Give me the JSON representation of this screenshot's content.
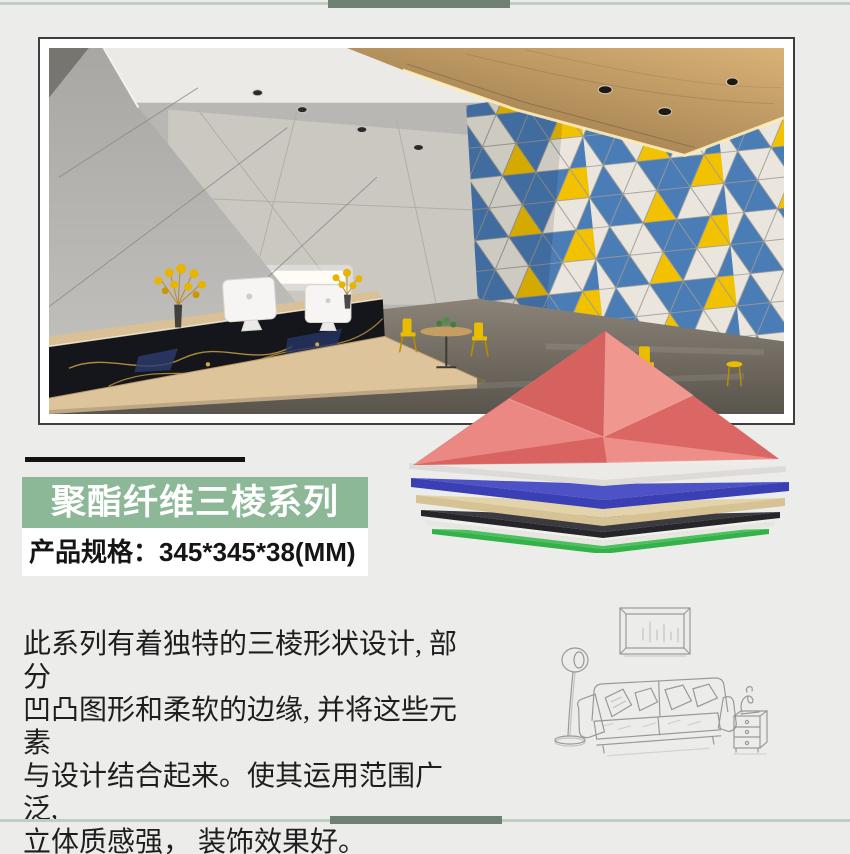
{
  "banner": {
    "label": "聚酯纤维三棱系列"
  },
  "spec": {
    "label": "产品规格：345*345*38(MM)"
  },
  "description": {
    "lines": [
      "此系列有着独特的三棱形状设计, 部分",
      "凹凸图形和柔软的边缘, 并将这些元素",
      "与设计结合起来。使其运用范围广泛,",
      "立体质感强， 装饰效果好。"
    ]
  },
  "images": {
    "hero": "office-lobby-with-triangle-acoustic-feature-wall",
    "product": "stacked-triangle-acoustic-felt-panels",
    "sketch": "hand-drawn-sofa-lamp-and-side-table"
  },
  "colors": {
    "page_bg": "#ecedeb",
    "decor_line": "#bdcfc2",
    "decor_bar": "#6f8172",
    "title_rule": "#121212",
    "banner_bg": "#8cb897",
    "banner_text": "#ffffff",
    "spec_bg": "#ffffff",
    "spec_text": "#151515",
    "desc_text": "#1e1e1e",
    "frame_border": "#3e3e3c",
    "frame_matte": "#ffffff",
    "sketch_stroke": "#909090",
    "panel_pink": "#e26e6a",
    "panel_pink_light": "#f09790",
    "panel_pink_dark": "#d4605d",
    "panel_white": "#dcdbd7",
    "panel_white_top": "#ebeae6",
    "panel_blue": "#3b3fb4",
    "panel_blue_top": "#4d52c6",
    "panel_tan": "#d6c294",
    "panel_tan_top": "#e3d3ab",
    "panel_black": "#26262a",
    "panel_black_top": "#3a3a40",
    "panel_white2": "#e8e6e2",
    "panel_white2_top": "#f2f0ec",
    "panel_green": "#35b14a",
    "panel_green_top": "#49c25d",
    "wall_blue": "#4a7cb5",
    "wall_yellow": "#f2c200",
    "wall_cream": "#eae6dd"
  }
}
